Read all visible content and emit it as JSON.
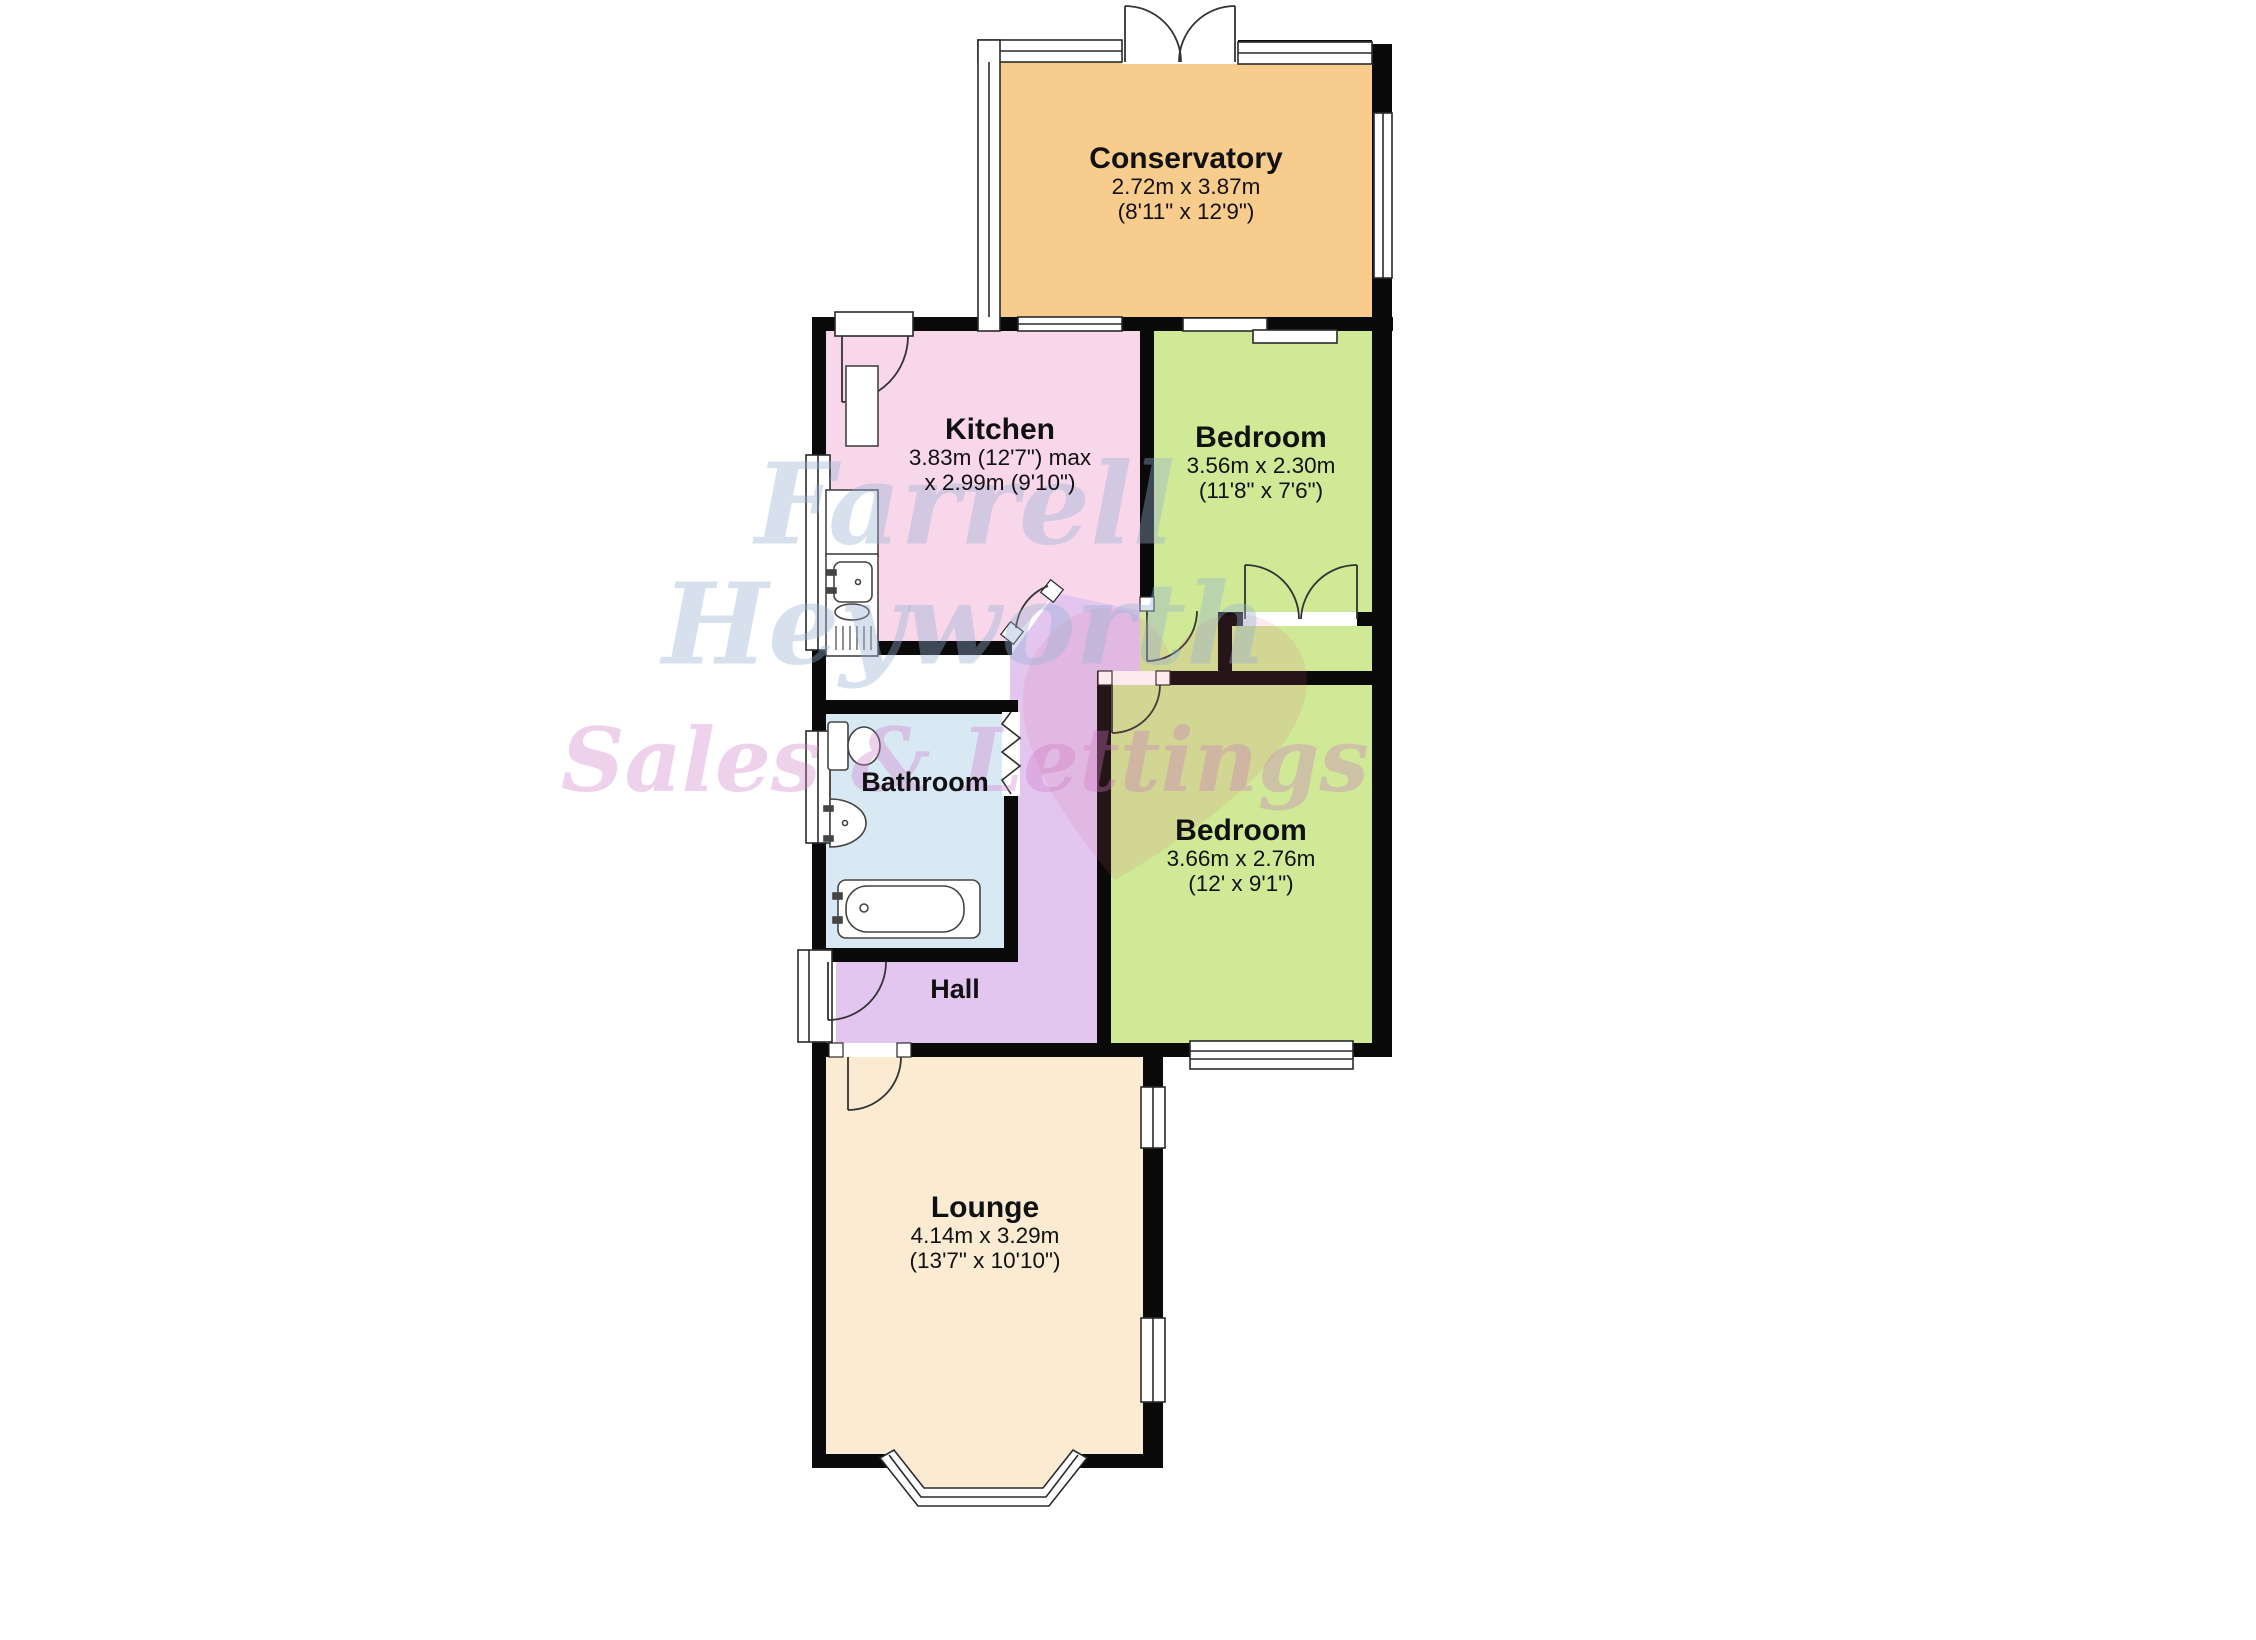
{
  "plan": {
    "type": "floorplan",
    "watermark": {
      "line1": "Farrell",
      "line2": "Heyworth",
      "line3": "Sales & Lettings"
    },
    "rooms": [
      {
        "id": "conservatory",
        "name": "Conservatory",
        "size_metric": "2.72m x 3.87m",
        "size_imperial": "(8'11\" x 12'9\")"
      },
      {
        "id": "kitchen",
        "name": "Kitchen",
        "size_metric": "3.83m (12'7\") max",
        "size_imperial": "x 2.99m (9'10\")"
      },
      {
        "id": "bedroom-1",
        "name": "Bedroom",
        "size_metric": "3.56m x 2.30m",
        "size_imperial": "(11'8\" x 7'6\")"
      },
      {
        "id": "bathroom",
        "name": "Bathroom",
        "size_metric": "",
        "size_imperial": ""
      },
      {
        "id": "bedroom-2",
        "name": "Bedroom",
        "size_metric": "3.66m x 2.76m",
        "size_imperial": "(12' x 9'1\")"
      },
      {
        "id": "hall",
        "name": "Hall",
        "size_metric": "",
        "size_imperial": ""
      },
      {
        "id": "lounge",
        "name": "Lounge",
        "size_metric": "4.14m x 3.29m",
        "size_imperial": "(13'7\" x 10'10\")"
      }
    ],
    "colors": {
      "conservatory": "#f8cc8d",
      "kitchen": "#f8d7ea",
      "bedroom": "#cfe996",
      "bathroom": "#d9e9f4",
      "hall": "#e2c6f0",
      "lounge": "#faebd2",
      "wall": "#0a0a0a",
      "heart": "#e05a78"
    }
  }
}
